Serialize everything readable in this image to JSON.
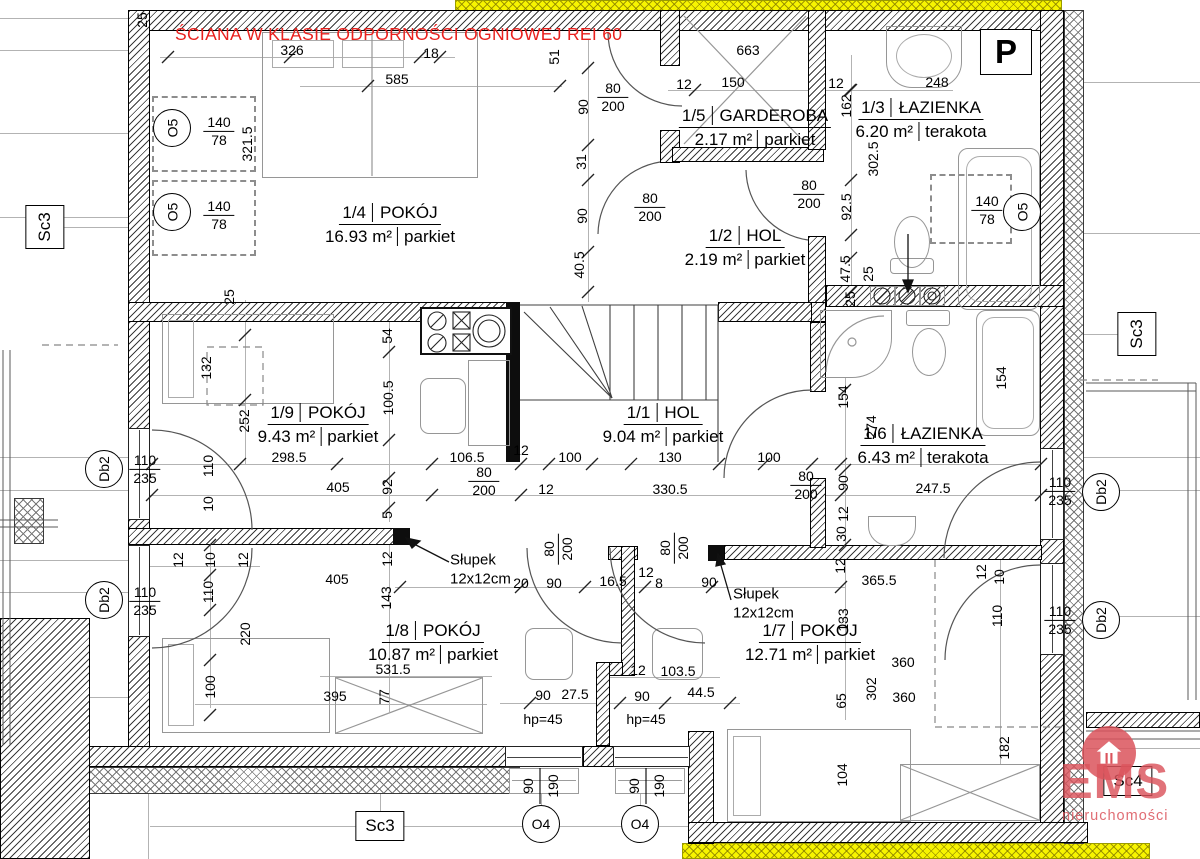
{
  "annotations": {
    "fire_rating_note": "ŚCIANA W KLASIE ODPORNOŚCI OGNIOWEJ REI 60",
    "posts": [
      {
        "line1": "Słupek",
        "line2": "12x12cm",
        "x": 450,
        "y": 570
      },
      {
        "line1": "Słupek",
        "line2": "12x12cm",
        "x": 733,
        "y": 604
      }
    ],
    "sill_height_labels": [
      {
        "t": "hp=45",
        "x": 543,
        "y": 719
      },
      {
        "t": "hp=45",
        "x": 646,
        "y": 719
      }
    ]
  },
  "rooms": [
    {
      "number": "1/4",
      "name": "POKÓJ",
      "area": "16.93 m²",
      "floor": "parkiet"
    },
    {
      "number": "1/5",
      "name": "GARDEROBA",
      "area": "2.17 m²",
      "floor": "parkiet"
    },
    {
      "number": "1/3",
      "name": "ŁAZIENKA",
      "area": "6.20 m²",
      "floor": "terakota"
    },
    {
      "number": "1/2",
      "name": "HOL",
      "area": "2.19 m²",
      "floor": "parkiet"
    },
    {
      "number": "1/9",
      "name": "POKÓJ",
      "area": "9.43 m²",
      "floor": "parkiet"
    },
    {
      "number": "1/1",
      "name": "HOL",
      "area": "9.04 m²",
      "floor": "parkiet"
    },
    {
      "number": "1/6",
      "name": "ŁAZIENKA",
      "area": "6.43 m²",
      "floor": "terakota"
    },
    {
      "number": "1/8",
      "name": "POKÓJ",
      "area": "10.87 m²",
      "floor": "parkiet"
    },
    {
      "number": "1/7",
      "name": "POKÓJ",
      "area": "12.71 m²",
      "floor": "parkiet"
    }
  ],
  "dims": [
    {
      "t": "25",
      "x": 142,
      "y": 20,
      "r": 1
    },
    {
      "t": "326",
      "x": 292,
      "y": 50
    },
    {
      "t": "18",
      "x": 431,
      "y": 53
    },
    {
      "t": "585",
      "x": 397,
      "y": 79
    },
    {
      "t": "51",
      "x": 554,
      "y": 57,
      "r": 1
    },
    {
      "t": "663",
      "x": 748,
      "y": 50
    },
    {
      "t": "12",
      "x": 684,
      "y": 84
    },
    {
      "t": "150",
      "x": 733,
      "y": 82
    },
    {
      "t": "12",
      "x": 836,
      "y": 83
    },
    {
      "t": "248",
      "x": 937,
      "y": 82
    },
    {
      "t": "162",
      "x": 846,
      "y": 106,
      "r": 1
    },
    {
      "t": "302.5",
      "x": 873,
      "y": 159,
      "r": 1
    },
    {
      "t": "90",
      "x": 583,
      "y": 107,
      "r": 1
    },
    {
      "t": "31",
      "x": 581,
      "y": 162,
      "r": 1
    },
    {
      "t": "90",
      "x": 582,
      "y": 216,
      "r": 1
    },
    {
      "t": "40.5",
      "x": 579,
      "y": 265,
      "r": 1
    },
    {
      "t": "92.5",
      "x": 846,
      "y": 207,
      "r": 1
    },
    {
      "t": "47.5",
      "x": 845,
      "y": 269,
      "r": 1
    },
    {
      "t": "25",
      "x": 868,
      "y": 274,
      "r": 1
    },
    {
      "t": "25",
      "x": 850,
      "y": 299,
      "r": 1
    },
    {
      "t": "25",
      "x": 229,
      "y": 297,
      "r": 1
    },
    {
      "t": "321.5",
      "x": 247,
      "y": 144,
      "r": 1
    },
    {
      "t": "54",
      "x": 387,
      "y": 336,
      "r": 1
    },
    {
      "t": "100.5",
      "x": 388,
      "y": 398,
      "r": 1
    },
    {
      "t": "132",
      "x": 206,
      "y": 368,
      "r": 1
    },
    {
      "t": "252",
      "x": 244,
      "y": 421,
      "r": 1
    },
    {
      "t": "154",
      "x": 843,
      "y": 397,
      "r": 1
    },
    {
      "t": "274",
      "x": 871,
      "y": 427,
      "r": 1
    },
    {
      "t": "154",
      "x": 1001,
      "y": 378,
      "r": 1
    },
    {
      "t": "298.5",
      "x": 289,
      "y": 457
    },
    {
      "t": "106.5",
      "x": 467,
      "y": 457
    },
    {
      "t": "12",
      "x": 521,
      "y": 450
    },
    {
      "t": "100",
      "x": 570,
      "y": 457
    },
    {
      "t": "130",
      "x": 670,
      "y": 457
    },
    {
      "t": "100",
      "x": 769,
      "y": 457
    },
    {
      "t": "405",
      "x": 338,
      "y": 487
    },
    {
      "t": "92",
      "x": 387,
      "y": 487,
      "r": 1
    },
    {
      "t": "12",
      "x": 546,
      "y": 489
    },
    {
      "t": "330.5",
      "x": 670,
      "y": 489
    },
    {
      "t": "5",
      "x": 387,
      "y": 515,
      "r": 1
    },
    {
      "t": "90",
      "x": 843,
      "y": 483,
      "r": 1
    },
    {
      "t": "247.5",
      "x": 933,
      "y": 488
    },
    {
      "t": "12",
      "x": 843,
      "y": 514,
      "r": 1
    },
    {
      "t": "30",
      "x": 841,
      "y": 534,
      "r": 1
    },
    {
      "t": "12",
      "x": 840,
      "y": 566,
      "r": 1
    },
    {
      "t": "110",
      "x": 208,
      "y": 466,
      "r": 1
    },
    {
      "t": "10",
      "x": 208,
      "y": 504,
      "r": 1
    },
    {
      "t": "12",
      "x": 178,
      "y": 560,
      "r": 1
    },
    {
      "t": "10",
      "x": 210,
      "y": 560,
      "r": 1
    },
    {
      "t": "12",
      "x": 243,
      "y": 560,
      "r": 1
    },
    {
      "t": "110",
      "x": 208,
      "y": 592,
      "r": 1
    },
    {
      "t": "220",
      "x": 245,
      "y": 634,
      "r": 1
    },
    {
      "t": "100",
      "x": 210,
      "y": 687,
      "r": 1
    },
    {
      "t": "405",
      "x": 337,
      "y": 579
    },
    {
      "t": "143",
      "x": 386,
      "y": 598,
      "r": 1
    },
    {
      "t": "12",
      "x": 387,
      "y": 559,
      "r": 1
    },
    {
      "t": "20",
      "x": 521,
      "y": 583
    },
    {
      "t": "90",
      "x": 554,
      "y": 583
    },
    {
      "t": "16.5",
      "x": 613,
      "y": 581
    },
    {
      "t": "12",
      "x": 646,
      "y": 572
    },
    {
      "t": "8",
      "x": 659,
      "y": 583
    },
    {
      "t": "90",
      "x": 709,
      "y": 582
    },
    {
      "t": "395",
      "x": 335,
      "y": 696
    },
    {
      "t": "77",
      "x": 384,
      "y": 697,
      "r": 1
    },
    {
      "t": "531.5",
      "x": 393,
      "y": 669
    },
    {
      "t": "90",
      "x": 543,
      "y": 695
    },
    {
      "t": "27.5",
      "x": 575,
      "y": 694
    },
    {
      "t": "90",
      "x": 642,
      "y": 696
    },
    {
      "t": "44.5",
      "x": 701,
      "y": 692
    },
    {
      "t": "12",
      "x": 638,
      "y": 670
    },
    {
      "t": "103.5",
      "x": 678,
      "y": 671
    },
    {
      "t": "365.5",
      "x": 879,
      "y": 580
    },
    {
      "t": "133",
      "x": 843,
      "y": 620,
      "r": 1
    },
    {
      "t": "110",
      "x": 997,
      "y": 616,
      "r": 1
    },
    {
      "t": "10",
      "x": 999,
      "y": 577,
      "r": 1
    },
    {
      "t": "12",
      "x": 981,
      "y": 572,
      "r": 1
    },
    {
      "t": "360",
      "x": 903,
      "y": 662
    },
    {
      "t": "360",
      "x": 904,
      "y": 697
    },
    {
      "t": "302",
      "x": 871,
      "y": 689,
      "r": 1
    },
    {
      "t": "65",
      "x": 841,
      "y": 701,
      "r": 1
    },
    {
      "t": "104",
      "x": 842,
      "y": 775,
      "r": 1
    },
    {
      "t": "182",
      "x": 1004,
      "y": 748,
      "r": 1
    },
    {
      "t": "90",
      "x": 528,
      "y": 786,
      "r": 1
    },
    {
      "t": "190",
      "x": 553,
      "y": 786,
      "r": 1
    },
    {
      "t": "90",
      "x": 634,
      "y": 786,
      "r": 1
    },
    {
      "t": "190",
      "x": 659,
      "y": 786,
      "r": 1
    }
  ],
  "door_labels": [
    {
      "top": "80",
      "bottom": "200",
      "x": 613,
      "y": 97
    },
    {
      "top": "80",
      "bottom": "200",
      "x": 650,
      "y": 207
    },
    {
      "top": "80",
      "bottom": "200",
      "x": 809,
      "y": 194
    },
    {
      "top": "80",
      "bottom": "200",
      "x": 484,
      "y": 481
    },
    {
      "top": "80",
      "bottom": "200",
      "x": 558,
      "y": 549,
      "r": 1
    },
    {
      "top": "80",
      "bottom": "200",
      "x": 674,
      "y": 548,
      "r": 1
    },
    {
      "top": "80",
      "bottom": "200",
      "x": 806,
      "y": 485
    }
  ],
  "window_labels": [
    {
      "top": "140",
      "bottom": "78",
      "x": 219,
      "y": 131
    },
    {
      "top": "140",
      "bottom": "78",
      "x": 219,
      "y": 215
    },
    {
      "top": "140",
      "bottom": "78",
      "x": 987,
      "y": 210
    },
    {
      "top": "110",
      "bottom": "235",
      "x": 145,
      "y": 469
    },
    {
      "top": "110",
      "bottom": "235",
      "x": 145,
      "y": 601
    },
    {
      "top": "110",
      "bottom": "235",
      "x": 1060,
      "y": 491
    },
    {
      "top": "110",
      "bottom": "235",
      "x": 1060,
      "y": 620
    }
  ],
  "ref_circles": [
    {
      "t": "O5",
      "x": 172,
      "y": 128,
      "r": 1
    },
    {
      "t": "O5",
      "x": 172,
      "y": 212,
      "r": 1
    },
    {
      "t": "O5",
      "x": 1022,
      "y": 212,
      "r": 1
    },
    {
      "t": "O4",
      "x": 541,
      "y": 824
    },
    {
      "t": "O4",
      "x": 640,
      "y": 824
    },
    {
      "t": "Db2",
      "x": 104,
      "y": 469,
      "r": 1
    },
    {
      "t": "Db2",
      "x": 104,
      "y": 600,
      "r": 1
    },
    {
      "t": "Db2",
      "x": 1101,
      "y": 492,
      "r": 1
    },
    {
      "t": "Db2",
      "x": 1101,
      "y": 620,
      "r": 1
    }
  ],
  "ref_boxes": [
    {
      "t": "Sc3",
      "x": 45,
      "y": 227,
      "r": 1
    },
    {
      "t": "Sc3",
      "x": 1137,
      "y": 334,
      "r": 1
    },
    {
      "t": "Sc3",
      "x": 380,
      "y": 826
    },
    {
      "t": "Sc4",
      "x": 1128,
      "y": 781
    },
    {
      "t": "P",
      "x": 1006,
      "y": 52,
      "big": 1
    }
  ],
  "logo": {
    "brand": "EMS",
    "subtitle": "nieruchomości"
  }
}
